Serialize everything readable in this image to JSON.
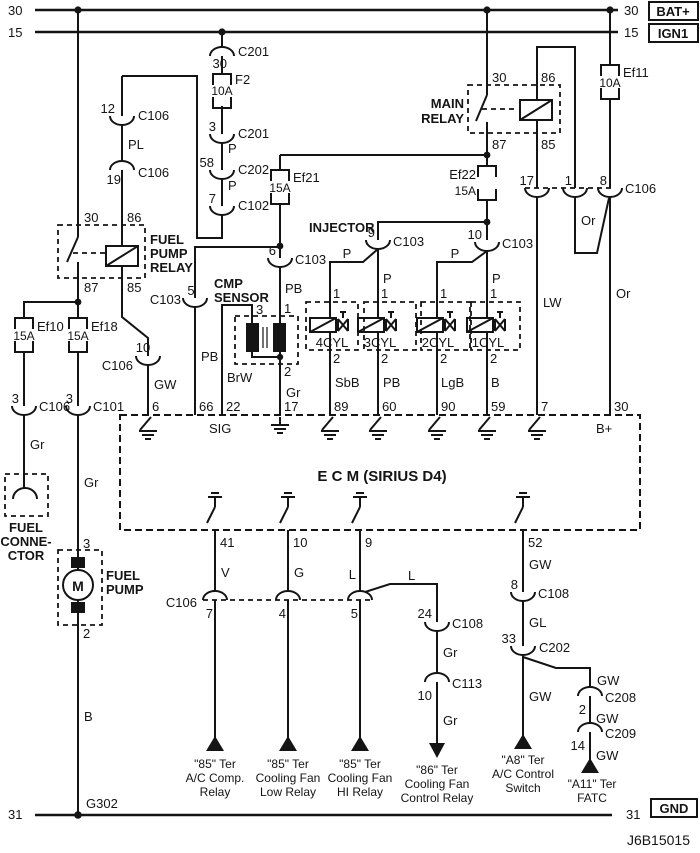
{
  "bus": {
    "b30": "30",
    "b15": "15",
    "b31": "31",
    "bat": "BAT+",
    "ign": "IGN1",
    "gnd": "GND",
    "g302": "G302",
    "code": "J6B15015"
  },
  "num": {
    "n1": "1",
    "n2": "2",
    "n3": "3",
    "n4": "4",
    "n5": "5",
    "n6": "6",
    "n7": "7",
    "n8": "8",
    "n9": "9",
    "n10": "10",
    "n12": "12",
    "n14": "14",
    "n17": "17",
    "n19": "19",
    "n22": "22",
    "n24": "24",
    "n30": "30",
    "n33": "33",
    "n41": "41",
    "n52": "52",
    "n58": "58",
    "n59": "59",
    "n60": "60",
    "n66": "66",
    "n85": "85",
    "n86": "86",
    "n87": "87",
    "n89": "89",
    "n90": "90"
  },
  "wire": {
    "p": "P",
    "pl": "PL",
    "pb": "PB",
    "brw": "BrW",
    "gr": "Gr",
    "gw": "GW",
    "sbb": "SbB",
    "lgb": "LgB",
    "b": "B",
    "lw": "LW",
    "or": "Or",
    "v": "V",
    "g": "G",
    "l": "L",
    "gl": "GL"
  },
  "conn": {
    "c201": "C201",
    "c202": "C202",
    "c102": "C102",
    "c106": "C106",
    "c101": "C101",
    "c103": "C103",
    "c108": "C108",
    "c113": "C113",
    "c208": "C208",
    "c209": "C209"
  },
  "fuse": {
    "f2": "F2",
    "ef11": "Ef11",
    "ef21": "Ef21",
    "ef22": "Ef22",
    "ef10": "Ef10",
    "ef18": "Ef18",
    "a10": "10A",
    "a15": "15A"
  },
  "relay": {
    "main1": "MAIN",
    "main2": "RELAY",
    "fp1": "FUEL",
    "fp2": "PUMP",
    "fp3": "RELAY"
  },
  "ecm": {
    "title": "E   C   M  (SIRIUS D4)",
    "sig": "SIG",
    "bplus": "B+"
  },
  "inj": {
    "title": "INJECTOR",
    "cyl4": "4CYL",
    "cyl3": "3CYL",
    "cyl2": "2CYL",
    "cyl1": "1CYL"
  },
  "cmp": {
    "l1": "CMP",
    "l2": "SENSOR"
  },
  "fuel_connector": {
    "l1": "FUEL",
    "l2": "CONNE-",
    "l3": "CTOR"
  },
  "fuel_pump": {
    "l1": "FUEL",
    "l2": "PUMP",
    "m": "M"
  },
  "dest": [
    {
      "l1": "\"85\" Ter",
      "l2": "A/C Comp.",
      "l3": "Relay"
    },
    {
      "l1": "\"85\" Ter",
      "l2": "Cooling Fan",
      "l3": "Low Relay"
    },
    {
      "l1": "\"85\" Ter",
      "l2": "Cooling Fan",
      "l3": "HI Relay"
    },
    {
      "l1": "\"86\" Ter",
      "l2": "Cooling Fan",
      "l3": "Control Relay"
    },
    {
      "l1": "\"A8\" Ter",
      "l2": "A/C Control",
      "l3": "Switch"
    },
    {
      "l1": "\"A11\" Ter",
      "l2": "FATC"
    }
  ]
}
